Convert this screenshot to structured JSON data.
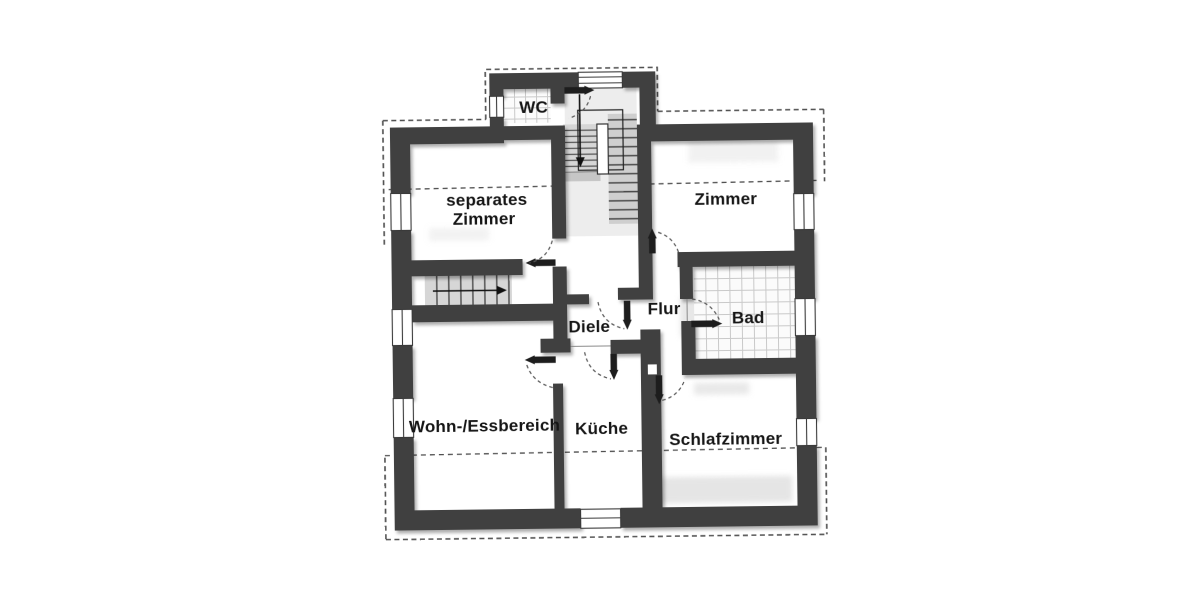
{
  "document": {
    "type": "scanned-floor-plan",
    "language": "de"
  },
  "rooms": {
    "wc": "WC",
    "separates_zimmer_line1": "separates",
    "separates_zimmer_line2": "Zimmer",
    "zimmer": "Zimmer",
    "diele": "Diele",
    "flur": "Flur",
    "bad": "Bad",
    "wohn_essbereich": "Wohn-/Essbereich",
    "kueche": "Küche",
    "schlafzimmer": "Schlafzimmer"
  },
  "colors": {
    "wall": "#3f3f3f",
    "dash": "#4f4f4f",
    "label": "#161616",
    "tile_line": "#c9c9c9",
    "stair_fill": "#d6d6d6",
    "paper": "#ffffff"
  }
}
